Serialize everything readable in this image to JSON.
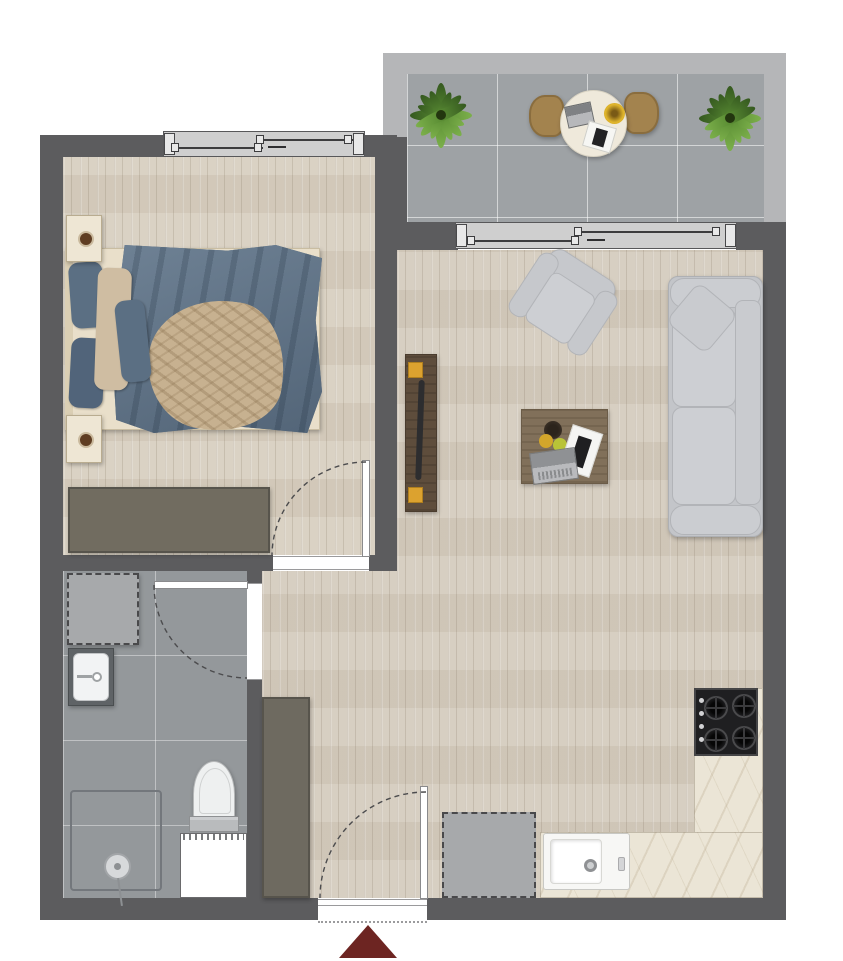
{
  "plan": {
    "type": "apartment-floor-plan",
    "orientation": "top-down",
    "entrance_marker": {
      "shape": "triangle-arrow",
      "direction": "up",
      "color": "#6d2522"
    },
    "palette": {
      "wall": "#5c5c5e",
      "balcony_parapet": "#b5b6b8",
      "wood_floor": "#d5ccbe",
      "balcony_tile": "#9ea2a5",
      "bathroom_tile": "#94989b",
      "kitchen_counter_marble": "#ebe5d6",
      "furniture_gray": "#c6c8cc",
      "cabinet_taupe": "#6e6a60",
      "table_wood": "#81705a",
      "duvet_blue": "#5d7083",
      "throw_beige": "#c7b190",
      "plant_green": "#5c8f35",
      "cooktop_black": "#1f1f21"
    },
    "rooms": {
      "balcony": {
        "name": "balcony",
        "floor": "gray tile",
        "items": [
          "plant",
          "round table",
          "2 chairs",
          "plant"
        ]
      },
      "bedroom": {
        "name": "bedroom",
        "floor": "wood plank",
        "items": [
          "double bed",
          "2 nightstands",
          "dresser",
          "sliding window"
        ]
      },
      "living": {
        "name": "living room",
        "floor": "wood plank",
        "items": [
          "sofa",
          "armchair",
          "coffee table",
          "tv console",
          "sliding balcony door"
        ]
      },
      "bathroom": {
        "name": "bathroom",
        "floor": "gray tile",
        "items": [
          "washing machine",
          "sink vanity",
          "toilet",
          "walk-in shower",
          "duct shaft"
        ]
      },
      "hall": {
        "name": "hallway",
        "floor": "wood plank",
        "items": [
          "tall cabinet",
          "entrance door"
        ]
      },
      "kitchen": {
        "name": "kitchen corner",
        "floor": "wood plank",
        "items": [
          "L-shaped counter",
          "4-burner cooktop",
          "sink",
          "appliance (dashed)"
        ]
      }
    },
    "doors": {
      "entrance": {
        "type": "hinged",
        "swing": "inward quarter-arc",
        "wall": "bottom"
      },
      "bedroom": {
        "type": "hinged",
        "swing": "into bedroom quarter-arc"
      },
      "bathroom": {
        "type": "hinged",
        "swing": "into bathroom quarter-arc"
      },
      "balcony": {
        "type": "sliding glass door"
      },
      "bedroom_window": {
        "type": "sliding window"
      }
    }
  }
}
